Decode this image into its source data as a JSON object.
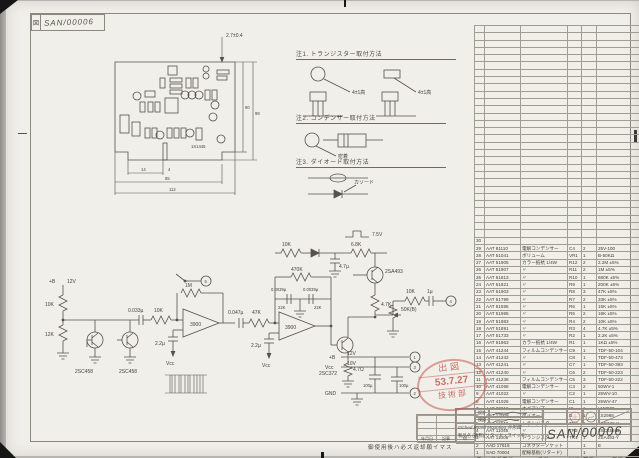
{
  "sheet": {
    "corner_tag": "図",
    "corner_no": "SAN/00006",
    "footer_note": "御使用後ハ必ズ返却願イマス"
  },
  "stamp": {
    "line1": "出図",
    "line2": "53.7.27",
    "line3": "技術部"
  },
  "pcb": {
    "dim_top": "2.7±0.4",
    "dim_right_a": "90",
    "dim_right_b": "98",
    "dim_b1": "14",
    "dim_b1b": "4",
    "dim_b2": "85",
    "dim_b3": "112",
    "part_label": "1S1445"
  },
  "notes": {
    "n1_heading": "注1. トランジスター取付方法",
    "n1_dim_a": "4±1高",
    "n1_dim_b": "4±1高",
    "n2_heading": "注2. コンデンサー取付方法",
    "n2_label": "密着",
    "n3_heading": "注3. ダイオード取付方法",
    "n3_label": "カソード"
  },
  "schematic": {
    "labels": {
      "supply": "+B",
      "supply_v": "12V",
      "r1": "10K",
      "r2": "12K",
      "q1": "2SC458",
      "q2": "2SC458",
      "cin": "0.033µ",
      "rin": "10K",
      "fb1": "1M",
      "oa1": "3900",
      "ce1": "2.2µ",
      "vcc1": "Vcc",
      "cc": "0.047µ",
      "rc": "47K",
      "ttc1": "0.0039µ",
      "ttc2": "0.0039µ",
      "ttr1": "22K",
      "ttr2": "22K",
      "fb2": "470K",
      "oa2": "3900",
      "ce2": "2.2µ",
      "vcc2": "Vcc",
      "rail_r1": "10K",
      "rail_c1": "4.7µ",
      "rail_r2": "6.8K",
      "q3": "2SA493",
      "r3": "4.7K",
      "q4": "2SC372",
      "r4": "4.7Ω",
      "pot": "50K(B)",
      "rout": "10K",
      "cout": "1µ",
      "pulse": "7.5V",
      "term_out": "4",
      "term_top": "5",
      "t1_name": "+B",
      "t1_v": "12V",
      "t1": "1",
      "t2_name": "Vcc",
      "t2_v": "10V",
      "t2": "3",
      "t3_name": "GND",
      "t3": "2",
      "cf1": "100µ",
      "cf2": "100µ"
    }
  },
  "parts_table": {
    "empty_rows": 29,
    "headers": [
      "番",
      "部品番号",
      "品名",
      "記号",
      "数量",
      "摘要"
    ],
    "rows": [
      [
        "30",
        "",
        "",
        "",
        "",
        ""
      ],
      [
        "29",
        "AAT 81110",
        "電解コンデンサー",
        "C4",
        "2",
        "25V-100"
      ],
      [
        "28",
        "AAT 51041",
        "ボリューム",
        "VR1",
        "1",
        "B-50KΩ"
      ],
      [
        "27",
        "AAT 51905",
        "カラー抵抗 1/4W",
        "R12",
        "2",
        "2.2M ±5%"
      ],
      [
        "26",
        "AAT 51907",
        "〃",
        "R11",
        "2",
        "1M ±5%"
      ],
      [
        "25",
        "AAT 51813",
        "〃",
        "R10",
        "1",
        "680K ±5%"
      ],
      [
        "24",
        "AAT 51821",
        "〃",
        "R9",
        "1",
        "200K ±5%"
      ],
      [
        "23",
        "AAT 51903",
        "〃",
        "R8",
        "3",
        "47K ±5%"
      ],
      [
        "22",
        "AAT 51799",
        "〃",
        "R7",
        "2",
        "33K ±5%"
      ],
      [
        "21",
        "AAT 51595",
        "〃",
        "R6",
        "1",
        "15K ±5%"
      ],
      [
        "20",
        "AAT 51985",
        "〃",
        "R5",
        "2",
        "18K ±5%"
      ],
      [
        "19",
        "AAT 51983",
        "〃",
        "R4",
        "2",
        "10K ±5%"
      ],
      [
        "18",
        "AAT 51891",
        "〃",
        "R3",
        "4",
        "4.7K ±5%"
      ],
      [
        "17",
        "AAT 51733",
        "〃",
        "R2",
        "1",
        "2.2K ±5%"
      ],
      [
        "16",
        "AAT 51963",
        "カラー抵抗 1/4W",
        "R1",
        "1",
        "1KΩ ±5%"
      ],
      [
        "15",
        "AAT 41244",
        "フィルムコンデンサー",
        "C9",
        "1",
        "TDF-50-104"
      ],
      [
        "14",
        "AAT 41242",
        "〃",
        "C8",
        "1",
        "TDF-50-473"
      ],
      [
        "13",
        "AAT 41241",
        "〃",
        "C7",
        "1",
        "TDF-50-393"
      ],
      [
        "12",
        "AAT 41240",
        "〃",
        "C6",
        "2",
        "TDF-50-223"
      ],
      [
        "11",
        "AAT 41238",
        "フィルムコンデンサー",
        "C5",
        "3",
        "TDF-50-222"
      ],
      [
        "10",
        "AAT 41098",
        "電解コンデンサー",
        "C3",
        "2",
        "50WV-1"
      ],
      [
        "9",
        "AAT 41022",
        "〃",
        "C2",
        "1",
        "25WV-10"
      ],
      [
        "8",
        "AAT 41026",
        "電解コンデンサー",
        "C1",
        "1",
        "25WV-47"
      ],
      [
        "7",
        "AAT 30816",
        "オペアンプ",
        "IC",
        "1",
        "LM3900"
      ],
      [
        "6",
        "AAT 12009",
        "ダイオード",
        "D",
        "1",
        "1S2988"
      ],
      [
        "5",
        "AAT 11043",
        "トランジスター",
        "TR3",
        "1",
        "2SC372-Y"
      ],
      [
        "4",
        "AAT 11045",
        "〃",
        "TR2",
        "2",
        "2SC458-B"
      ],
      [
        "3",
        "AAT 11005",
        "トランジスター",
        "TR1",
        "1",
        "2SA493-Y"
      ],
      [
        "2",
        "AAD 17616",
        "コネクターソケット",
        "",
        "1",
        "E"
      ],
      [
        "1",
        "SAD 70004",
        "配線基板(リタード)",
        "",
        "1",
        ""
      ]
    ]
  },
  "title_block": {
    "sign1_label": "設計",
    "sign2_label": "検図",
    "title_line1": "Etched Board Mounting 外形図",
    "title_line2": "製品名 (通称)(リタード・スイッチ)",
    "drawing_no": "SAN/00006",
    "company": "パシフィック㈱",
    "rev_headers": [
      "年月日",
      "記事",
      "印"
    ]
  }
}
